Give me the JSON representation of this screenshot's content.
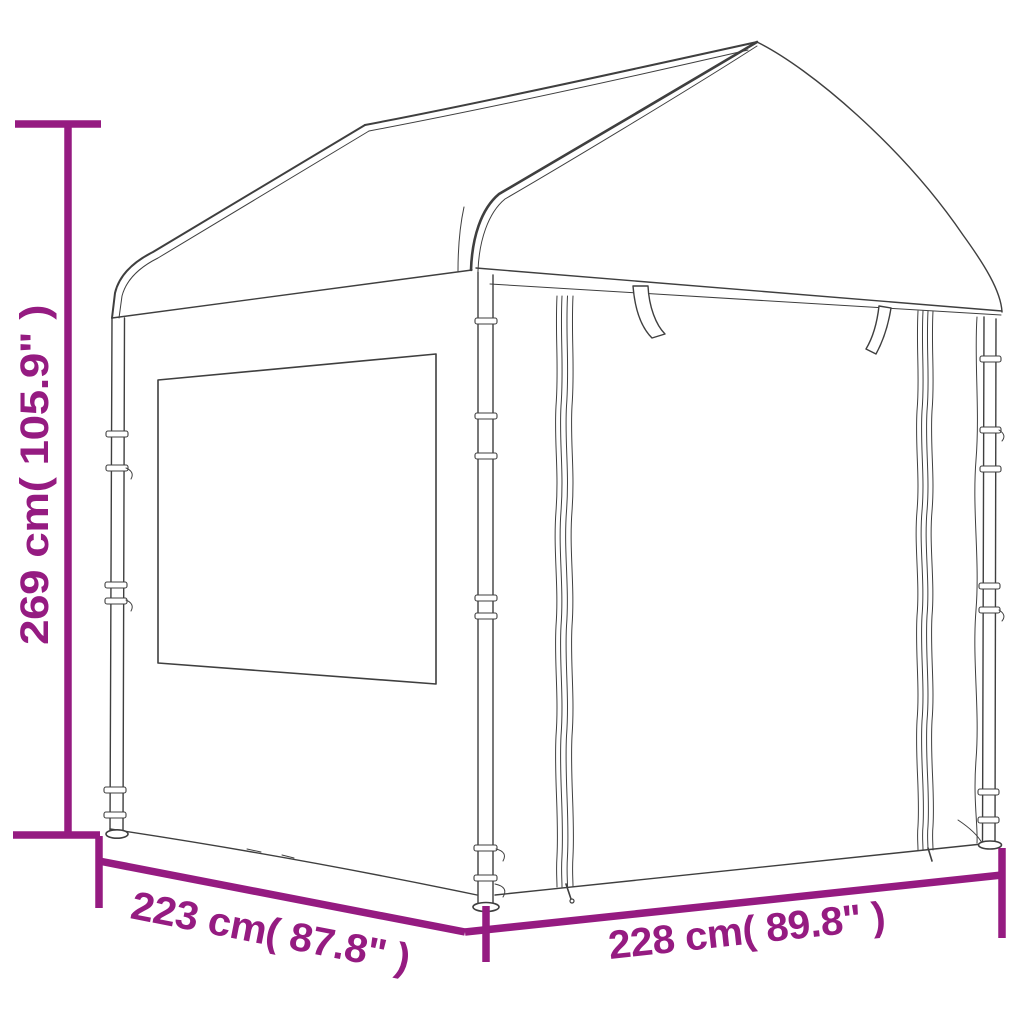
{
  "diagram": {
    "type": "product-dimension-drawing",
    "subject": "gazebo-canopy-tent-line-drawing",
    "accent_color": "#951b81",
    "line_color": "#3f3f3f",
    "labels": {
      "height": "269 cm( 105.9\" )",
      "depth": "223 cm( 87.8\" )",
      "width": "228 cm( 89.8\" )"
    }
  }
}
